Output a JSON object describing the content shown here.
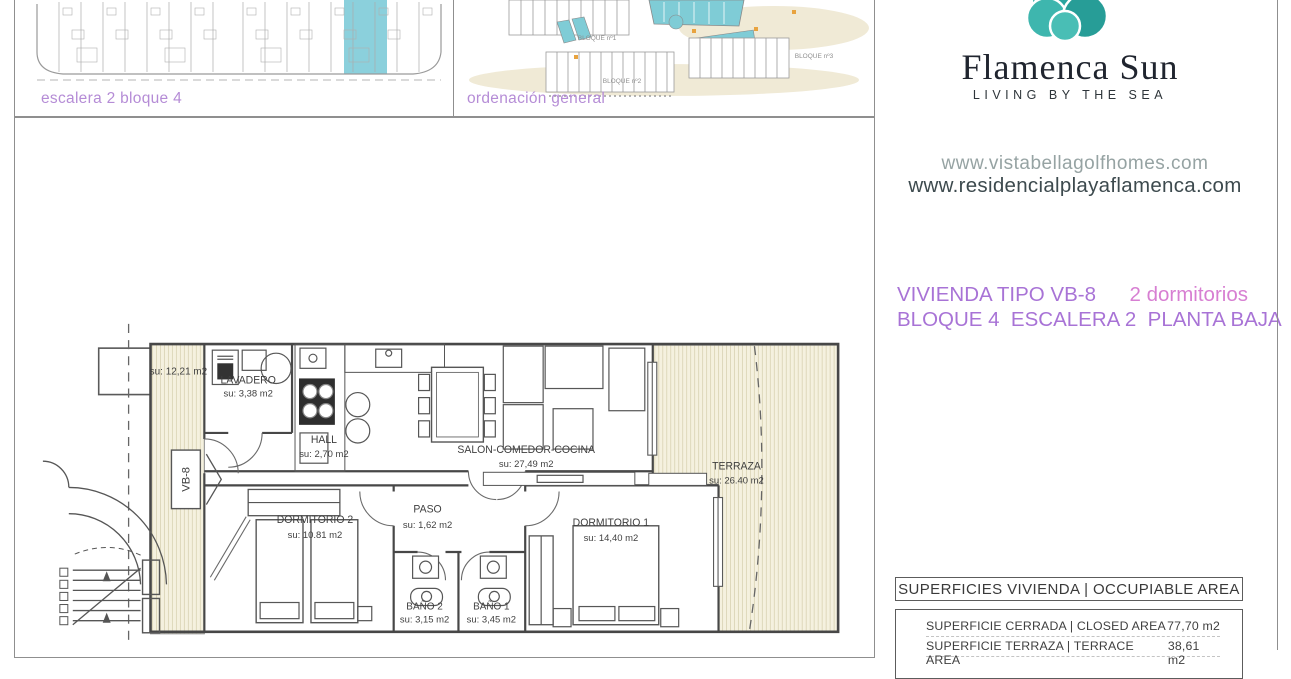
{
  "brand": {
    "name": "Flamenca Sun",
    "tagline": "LIVING BY THE SEA"
  },
  "websites": {
    "primary": "www.vistabellagolfhomes.com",
    "secondary": "www.residencialplayaflamenca.com"
  },
  "unit": {
    "type_label": "VIVIENDA TIPO VB-8",
    "bedrooms_label": "2 dormitorios",
    "location_label": "BLOQUE 4  ESCALERA 2  PLANTA BAJA"
  },
  "thumbnails": {
    "block_plan": {
      "caption": "escalera 2 bloque 4"
    },
    "site_plan": {
      "caption": "ordenación general",
      "labels": [
        "BLOQUE nº1",
        "BLOQUE nº2",
        "BLOQUE nº3"
      ]
    }
  },
  "plan": {
    "unit_tag": "VB-8",
    "rooms": [
      {
        "name": "",
        "area": "su: 12,21 m2"
      },
      {
        "name": "LAVADERO",
        "area": "su: 3,38 m2"
      },
      {
        "name": "HALL",
        "area": "su: 2,70 m2"
      },
      {
        "name": "SALON-COMEDOR-COCINA",
        "area": "su: 27,49 m2"
      },
      {
        "name": "TERRAZA",
        "area": "su: 26.40 m2"
      },
      {
        "name": "DORMITORIO 2",
        "area": "su: 10.81 m2"
      },
      {
        "name": "PASO",
        "area": "su: 1,62 m2"
      },
      {
        "name": "DORMITORIO 1",
        "area": "su: 14,40 m2"
      },
      {
        "name": "BAÑO 2",
        "area": "su: 3,15 m2"
      },
      {
        "name": "BAÑO 1",
        "area": "su: 3,45 m2"
      }
    ]
  },
  "areas_table": {
    "header": "SUPERFICIES VIVIENDA | OCCUPIABLE AREA",
    "rows": [
      {
        "label": "SUPERFICIE CERRADA | CLOSED AREA",
        "value": "77,70 m2"
      },
      {
        "label": "SUPERFICIE TERRAZA  | TERRACE AREA",
        "value": "38,61 m2"
      }
    ]
  },
  "colors": {
    "caption_purple": "#b58cd6",
    "title_purple": "#a873d6",
    "title_pink": "#d77fd2",
    "brand_teal": "#2aa59f",
    "brand_orange": "#f0a23e",
    "brand_navy": "#20252f",
    "highlight_teal": "#8bd0dc",
    "hatch_fill": "#f5f1df",
    "plan_line": "#4a4a4a"
  }
}
